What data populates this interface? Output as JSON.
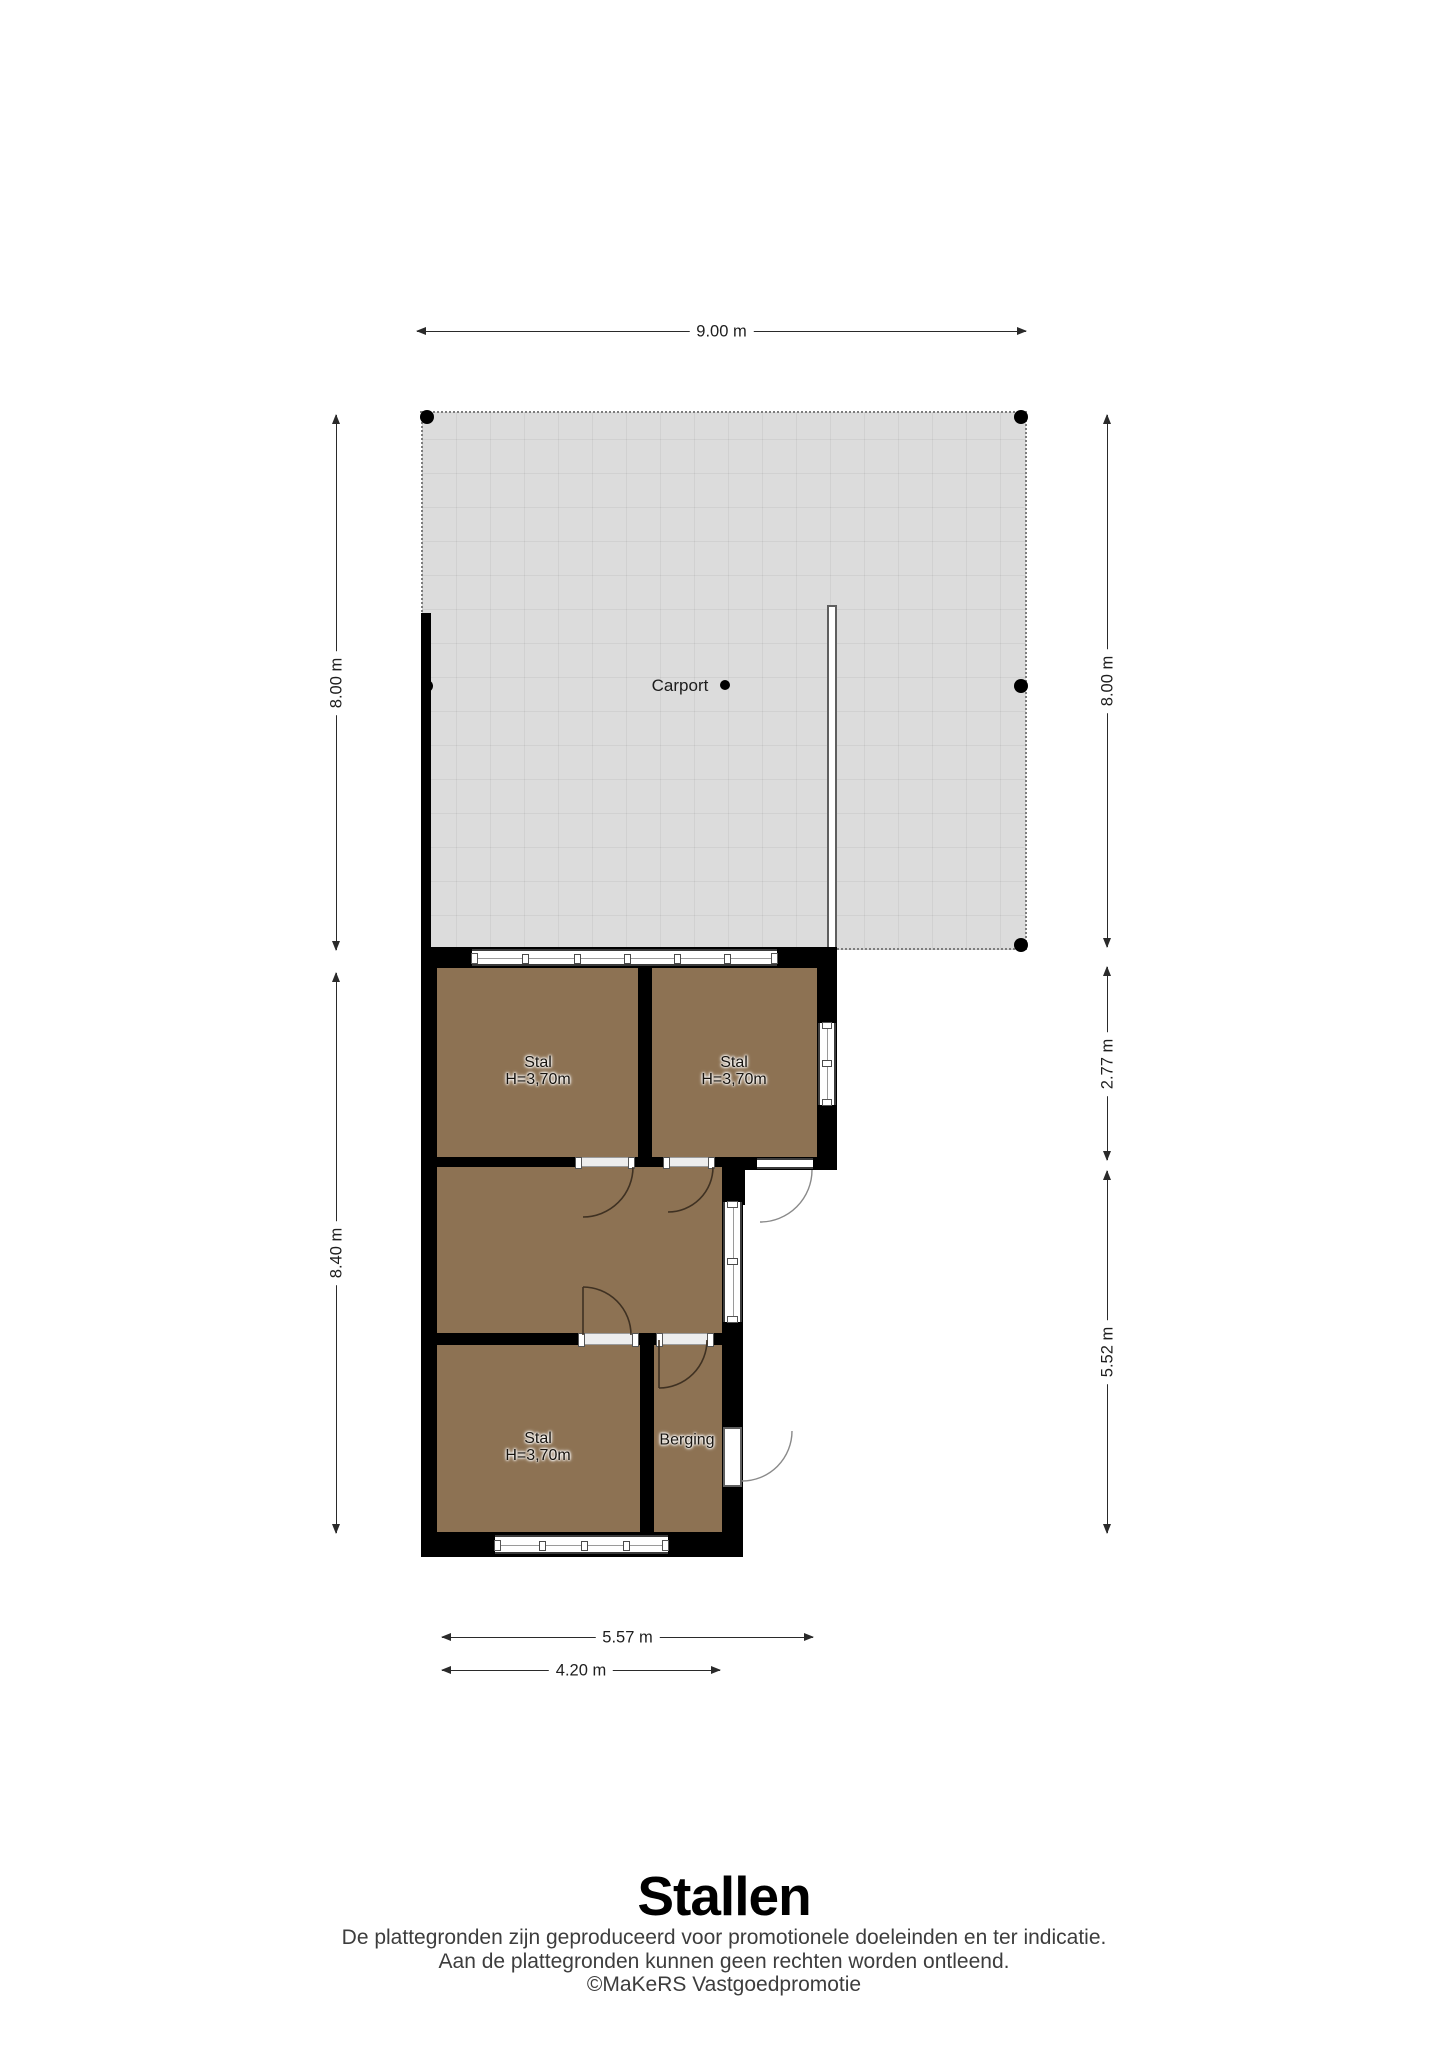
{
  "title": "Stallen",
  "disclaimer": {
    "line1": "De plattegronden zijn geproduceerd voor promotionele doeleinden en ter indicatie.",
    "line2": "Aan de plattegronden kunnen geen rechten worden ontleend.",
    "line3": "©MaKeRS Vastgoedpromotie"
  },
  "rooms": {
    "carport": {
      "label": "Carport"
    },
    "stal1": {
      "label": "Stal",
      "ceiling": "H=3,70m"
    },
    "stal2": {
      "label": "Stal",
      "ceiling": "H=3,70m"
    },
    "stal3": {
      "label": "Stal",
      "ceiling": "H=3,70m"
    },
    "berging": {
      "label": "Berging"
    }
  },
  "dimensions": {
    "carport_width": "9.00 m",
    "carport_height_left": "8.00 m",
    "carport_height_right": "8.00 m",
    "building_height_left": "8.40 m",
    "top_section_right": "2.77 m",
    "bottom_section_right": "5.52 m",
    "bottom_width_outer": "5.57 m",
    "bottom_width_inner": "4.20 m"
  },
  "colors": {
    "wall": "#000000",
    "room_fill": "#8d7253",
    "carport_fill": "#dcdcdc",
    "dimension": "#2a2a2a"
  }
}
